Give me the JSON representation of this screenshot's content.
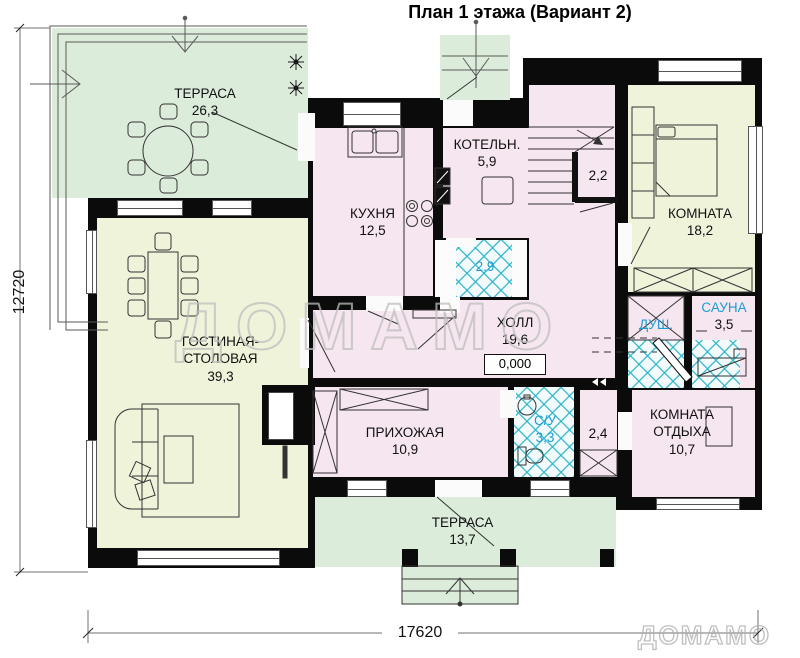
{
  "title": "План 1 этажа (Вариант 2)",
  "watermarks": {
    "center": "ДОМАМО",
    "corner": "ДОМАМО"
  },
  "dimensions": {
    "bottom": "17620",
    "left": "12720"
  },
  "rooms": {
    "terrace_top": {
      "name": "ТЕРРАСА",
      "area": "26,3"
    },
    "kitchen": {
      "name": "КУХНЯ",
      "area": "12,5"
    },
    "boiler": {
      "name": "КОТЕЛЬН.",
      "area": "5,9"
    },
    "bath_small": {
      "area": "2,9"
    },
    "stair_closet": {
      "area": "2,2"
    },
    "bedroom": {
      "name": "КОМНАТА",
      "area": "18,2"
    },
    "living": {
      "name": "ГОСТИНАЯ-СТОЛОВАЯ",
      "area": "39,3"
    },
    "hall": {
      "name": "ХОЛЛ",
      "area": "19,6",
      "elevation": "0,000"
    },
    "shower": {
      "name": "ДУШ."
    },
    "sauna": {
      "name": "САУНА",
      "area": "3,5"
    },
    "entry_hall": {
      "name": "ПРИХОЖАЯ",
      "area": "10,9"
    },
    "wc": {
      "name": "С/У",
      "area": "3,3"
    },
    "closet": {
      "area": "2,4"
    },
    "rest_room": {
      "name": "КОМНАТА ОТДЫХА",
      "area": "10,7"
    },
    "terrace_bottom": {
      "name": "ТЕРРАСА",
      "area": "13,7"
    }
  },
  "colors": {
    "wall": "#0b0b0b",
    "terrace_fill": "#dcecdb",
    "warm_room_fill": "#eff3da",
    "pink_room_fill": "#f5e6f0",
    "tile_line": "#2ab5c8",
    "wet_label_blue": "#1b9cd4"
  }
}
